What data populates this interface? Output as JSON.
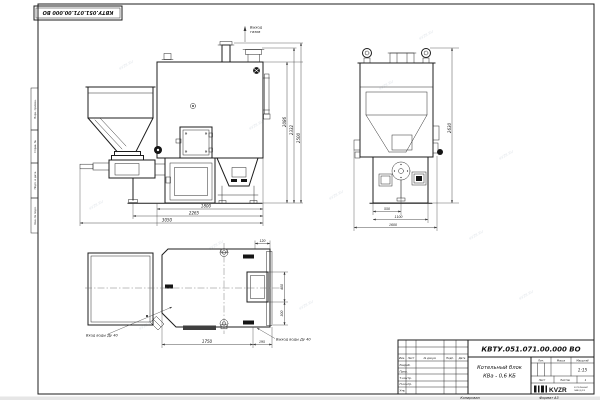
{
  "watermark": "KVZR.RU",
  "stamp": {
    "designation": "КВТУ.051.071.00.000 ВО"
  },
  "side_columns": [
    "Перв. примен.",
    "Справ. №",
    "Подп. и дата",
    "Инв. № подл."
  ],
  "views": {
    "front": {
      "gas_callout": [
        "Выход",
        "газов"
      ],
      "bottom_dims": [
        "1800",
        "2265",
        "3050"
      ],
      "height_dims": [
        "2086",
        "2332",
        "2500"
      ]
    },
    "side": {
      "bottom_dims": [
        "550",
        "1100",
        "1600"
      ],
      "height_dim": "2630"
    },
    "plan": {
      "inlet_callout": "Вход воды Ду 40",
      "outlet_callout": "Выход воды Ду 40",
      "length_dim": "1750",
      "offset_dim": "195",
      "top_dim": "120",
      "door_dim": "400",
      "side_dim": "300"
    }
  },
  "title_block": {
    "designation": "КВТУ.051.071.00.000 ВО",
    "name_line1": "Котельный блок",
    "name_line2": "КВа - 0,6 КБ",
    "header_cols": [
      "Изм.",
      "Лист",
      "№ докум.",
      "Подп.",
      "Дата"
    ],
    "rows": [
      "Разраб.",
      "Пров.",
      "Т.контр.",
      "Н.контр.",
      "Утв."
    ],
    "lit_label": "Лит.",
    "mass_label": "Масса",
    "scale_label": "Масштаб",
    "scale_value": "1:15",
    "sheet_label": "Лист",
    "sheets_label": "Листов",
    "sheets_value": "1",
    "logo_text": "KVZR",
    "logo_sub1": "КОТЕЛЬНЫЙ",
    "logo_sub2": "ЗАВОД.РФ",
    "copied_label": "Копировал",
    "format_label": "Формат А3"
  }
}
